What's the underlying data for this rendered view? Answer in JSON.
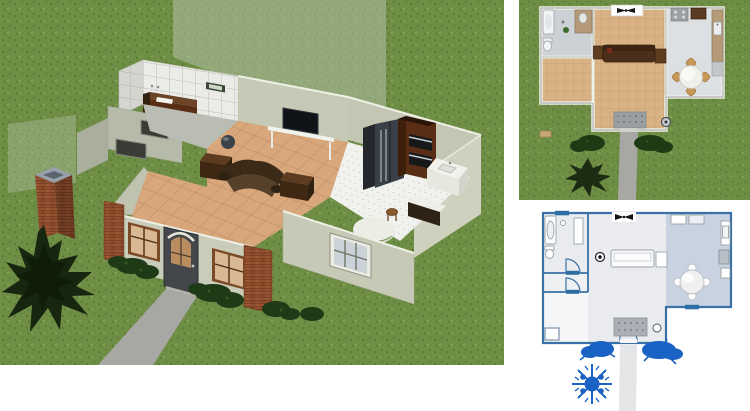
{
  "app": {
    "description": "Composite screenshot of three linked views from a home-design program: a 3D dollhouse overview render, a textured top-down plan view, and a blueprint-style 2D floor plan",
    "background": "#ffffff"
  },
  "colors": {
    "grass": "#6f8e45",
    "grass_dark": "#5d7b37",
    "grass_light": "#7fa052",
    "ghost_plane": "#b7c3ae",
    "wall": "#c6c9b5",
    "wall_shade": "#b6baa8",
    "tile_floor": "#d8a77c",
    "tile_grout": "#c19067",
    "kitchen_floor": "#f1f2ee",
    "bath_tile": "#ebebe7",
    "brick": "#93502e",
    "walkway": "#a7a8a3",
    "front_door": "#43474b",
    "window_frame": "#7b4a26",
    "window_glass": "#d9b894",
    "couch": "#4a2f1a",
    "wood_furniture": "#5f3c1f",
    "tv": "#101318",
    "fridge": "#394047",
    "oven_cabinet": "#5a2e15",
    "counter": "#f1f2ec",
    "bush": "#1f3a16",
    "tree": "#17270f",
    "plan_wood": "#d9b285",
    "plan_bath_floor": "#ccd1d5",
    "plan_kitchen_floor": "#dde0e2",
    "plan_counter": "#b59a78",
    "plan_chair": "#c89858",
    "plan_stoop": "#9b9fa3",
    "blueprint_line": "#3a72a8",
    "blueprint_room": "#e9ebee",
    "blueprint_kitchen": "#c9d2e0",
    "blueprint_foliage": "#1a63c4",
    "blueprint_walkway": "#e4e5e6"
  },
  "panels": {
    "dollhouse": {
      "label": "3D dollhouse overview render",
      "objects": [
        "grass yard",
        "translucent cut-away roof planes",
        "brick chimney",
        "dark pine tree",
        "tiled bathroom with wood vanity and small window",
        "living room with sofa, two end tables, TV on white console",
        "kitchen with side-by-side refrigerator, double wall oven cabinet, sink counter",
        "round dining table and wooden stool",
        "front facade with brick corner pillars, arched front door, two brown-framed windows",
        "white-framed side window",
        "green shrubs",
        "concrete walkway"
      ]
    },
    "plan_top": {
      "label": "Textured top-down plan view",
      "objects": [
        "bathroom with tub, toilet, tan vanity",
        "wood parquet living area",
        "sofa with end tables",
        "ceiling-fan symbol",
        "kitchen with range, refrigerator, tan counters, sink",
        "round dining table with four chairs",
        "front stoop with dotted surface",
        "walkway",
        "shrubs",
        "dark tree",
        "stepping stone"
      ]
    },
    "plan_blueprint": {
      "label": "Blueprint-style 2D floor plan",
      "objects": [
        "blue wall lines",
        "window symbols",
        "door swing arcs",
        "bathtub, toilet, cabinet outlines",
        "sofa outline with end table",
        "ceiling-fan symbol",
        "recessed light symbol",
        "kitchen counters, appliances, round table with chairs",
        "dotted front stoop",
        "blue shrubs",
        "blue snowflake tree",
        "gray walkway"
      ]
    }
  }
}
